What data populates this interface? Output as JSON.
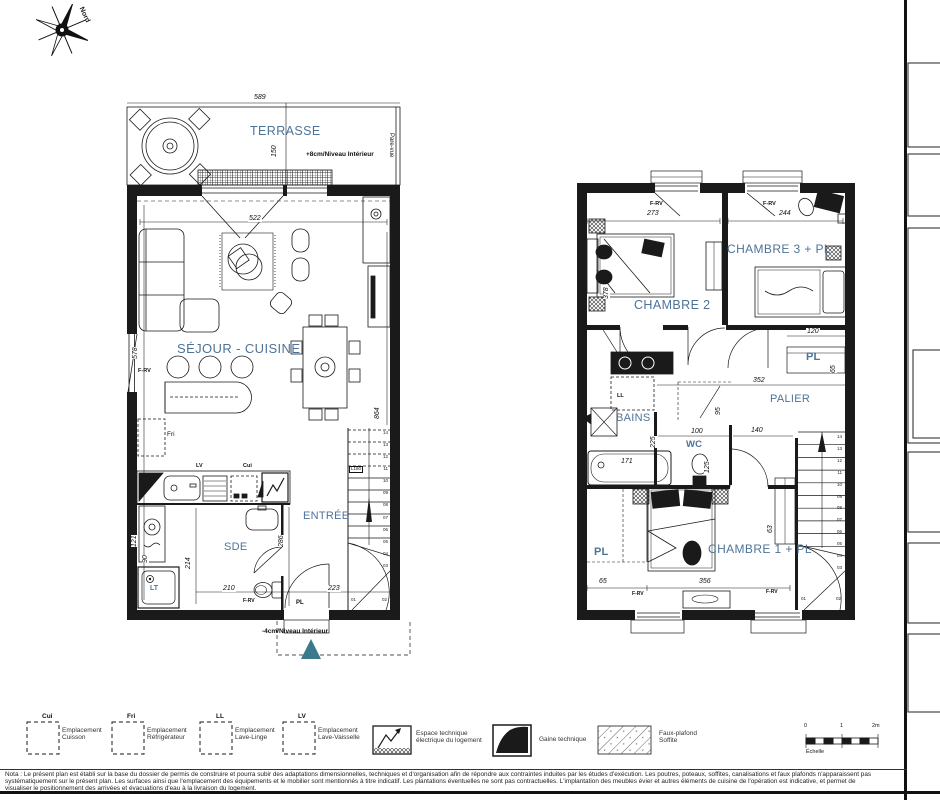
{
  "compass": {
    "north": "Nord"
  },
  "ground": {
    "terrace": {
      "label": "TERRASSE",
      "level": "+8cm/Niveau Intérieur",
      "pare_vue": "Pare-vue",
      "w": "589",
      "h": "150"
    },
    "rooms": {
      "sejour": "SÉJOUR - CUISINE",
      "entree": "ENTRÉE",
      "sde": "SDE",
      "pl": "PL",
      "lt": "LT"
    },
    "level_bottom": "-4cm/Niveau Intérieur",
    "labels": {
      "fri": "Fri",
      "lv": "LV",
      "cui": "Cui",
      "frv_left": "F-RV",
      "frv_door": "F-RV"
    },
    "dims": {
      "d522": "522",
      "d578": "578",
      "d864": "864",
      "d214": "214",
      "d286": "286",
      "d121": "121",
      "d90": "90",
      "d210": "210",
      "d223": "223"
    },
    "stairs": {
      "l160": "L160",
      "steps": [
        "14",
        "13",
        "12",
        "11",
        "10",
        "09",
        "08",
        "07",
        "06",
        "05",
        "04",
        "03"
      ],
      "s01": "01",
      "s02": "02"
    }
  },
  "upper": {
    "rooms": {
      "chambre2": "CHAMBRE 2",
      "chambre3": "CHAMBRE 3 + PL",
      "chambre1": "CHAMBRE 1 + PL",
      "palier": "PALIER",
      "bains": "BAINS",
      "wc": "WC",
      "pl_palier": "PL",
      "pl_ch1": "PL",
      "ll": "LL"
    },
    "dims": {
      "d273": "273",
      "d244": "244",
      "d378": "378",
      "d120": "120",
      "d65pl": "65",
      "d352": "352",
      "d95": "95",
      "d100": "100",
      "d140": "140",
      "d125": "125",
      "d225": "225",
      "d171": "171",
      "d63": "63",
      "d65": "65",
      "d356": "356"
    },
    "windows": {
      "frv1": "F-RV",
      "frv2": "F-RV",
      "frv3": "F-RV",
      "frv4": "F-RV"
    },
    "stairs": {
      "steps": [
        "14",
        "13",
        "12",
        "11",
        "10",
        "09",
        "08",
        "07",
        "06",
        "05",
        "04",
        "03"
      ],
      "s01": "01",
      "s02": "02"
    }
  },
  "legend": {
    "items": [
      {
        "code": "Cui",
        "line1": "Emplacement",
        "line2": "Cuisson"
      },
      {
        "code": "Fri",
        "line1": "Emplacement",
        "line2": "Réfrigérateur"
      },
      {
        "code": "LL",
        "line1": "Emplacement",
        "line2": "Lave-Linge"
      },
      {
        "code": "LV",
        "line1": "Emplacement",
        "line2": "Lave-Vaisselle"
      }
    ],
    "electric": {
      "line1": "Espace technique",
      "line2": "électrique du logement"
    },
    "gaine": "Gaine technique",
    "faux_plafond": {
      "line1": "Faux-plafond",
      "line2": "Soffite"
    },
    "scale": {
      "t0": "0",
      "t1": "1",
      "t2": "2m",
      "label": "Échelle"
    }
  },
  "nota": {
    "line1": "Nota : Le présent plan est établi sur la base du dossier de permis de construire et pourra subir des adaptations dimensionnelles, techniques et d'organisation afin de répondre aux contraintes induites par les études d'exécution. Les poutres, poteaux, soffites, canalisations et faux plafonds n'apparaissent pas",
    "line2": "systématiquement sur le présent plan. Les surfaces ainsi que l'emplacement des équipements et le mobilier sont mentionnés à titre indicatif. Les plantations éventuelles ne sont pas contractuelles. L'implantation des meubles évier et autres éléments de cuisine de l'opération est indicative, et permet de",
    "line3": "visualiser le positionnement des arrivées et évacuations d'eau à la livraison du logement."
  },
  "colors": {
    "room_label": "#4e7398",
    "entry_marker": "#3a7a8a"
  }
}
